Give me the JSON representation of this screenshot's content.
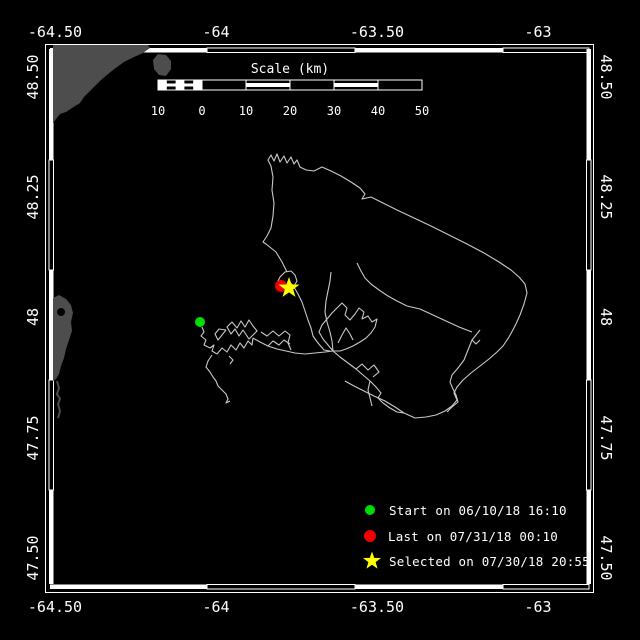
{
  "axes": {
    "x_ticks": [
      "-64.50",
      "-64",
      "-63.50",
      "-63"
    ],
    "y_ticks": [
      "48.50",
      "48.25",
      "48",
      "47.75",
      "47.50"
    ]
  },
  "scale_bar": {
    "title": "Scale (km)",
    "labels": [
      "10",
      "0",
      "10",
      "20",
      "30",
      "40",
      "50"
    ]
  },
  "legend": {
    "items": [
      {
        "marker": "circle",
        "color": "#00dd00",
        "label": "Start on 06/10/18 16:10"
      },
      {
        "marker": "circle",
        "color": "#ee0000",
        "label": "Last on 07/31/18 00:10"
      },
      {
        "marker": "star",
        "color": "#ffff00",
        "label": "Selected on 07/30/18 20:55"
      }
    ]
  },
  "markers": {
    "start": {
      "color": "#00dd00",
      "approx_lon": -64.05,
      "approx_lat": 47.99
    },
    "last": {
      "color": "#ee0000",
      "approx_lon": -63.8,
      "approx_lat": 48.06
    },
    "selected": {
      "color": "#ffff00",
      "approx_lon": -63.77,
      "approx_lat": 48.06
    }
  },
  "colors": {
    "background": "#000000",
    "frame": "#ffffff",
    "land": "#4d4d4d",
    "track": "#c9c9c9"
  }
}
